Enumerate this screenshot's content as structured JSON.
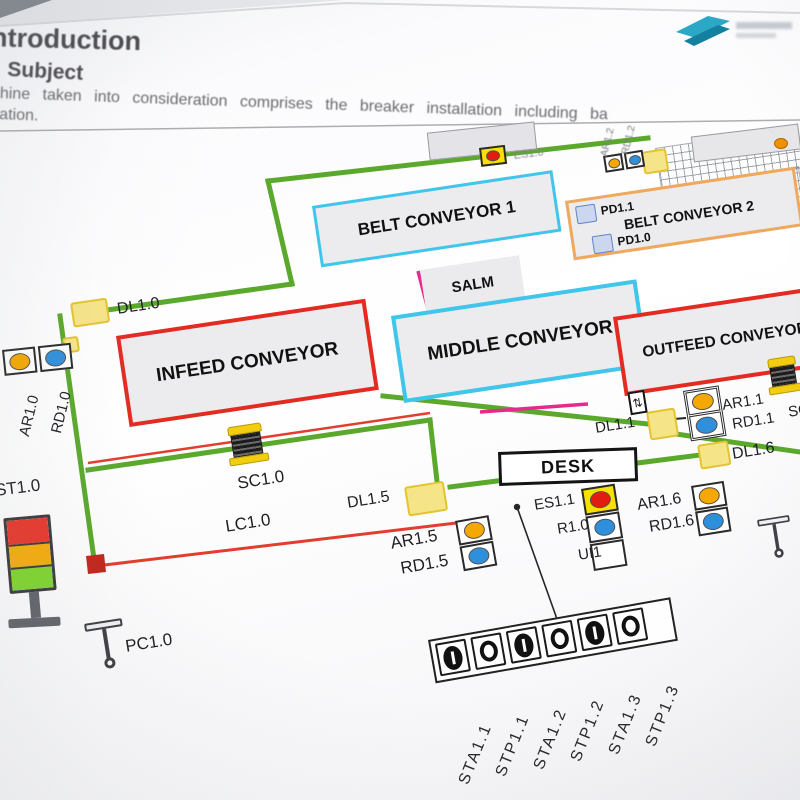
{
  "page": {
    "heading": "Introduction",
    "subheading": "Subject",
    "body_line1": "machine taken into consideration comprises the breaker installation including ba",
    "body_line2": "lation."
  },
  "diagram": {
    "boxes": {
      "belt_conveyor_1": "BELT CONVEYOR 1",
      "belt_conveyor_2": "BELT CONVEYOR 2",
      "salm": "SALM",
      "infeed": "INFEED CONVEYOR",
      "middle": "MIDDLE CONVEYOR",
      "outfeed": "OUTFEED CONVEYOR",
      "desk": "DESK"
    },
    "devices": {
      "dl10": "DL1.0",
      "dl11": "DL1.1",
      "dl15": "DL1.5",
      "dl16": "DL1.6",
      "ar10": "AR1.0",
      "rd10": "RD1.0",
      "ar11": "AR1.1",
      "rd11": "RD1.1",
      "ar12": "AR1.2",
      "rd12": "RD1.2",
      "ar15": "AR1.5",
      "rd15": "RD1.5",
      "ar16": "AR1.6",
      "rd16": "RD1.6",
      "es10": "ES1.0",
      "es11": "ES1.1",
      "r10": "R1.0",
      "ui1": "UI1",
      "st10": "ST1.0",
      "sc10": "SC1.0",
      "sc11": "SC1.1",
      "lc10": "LC1.0",
      "pc10": "PC1.0",
      "pd11": "PD1.1",
      "pd10": "PD1.0"
    },
    "buttons": [
      {
        "label": "STA1.1",
        "type": "start"
      },
      {
        "label": "STP1.1",
        "type": "stop"
      },
      {
        "label": "STA1.2",
        "type": "start"
      },
      {
        "label": "STP1.2",
        "type": "stop"
      },
      {
        "label": "STA1.3",
        "type": "start"
      },
      {
        "label": "STP1.3",
        "type": "stop"
      }
    ],
    "colors": {
      "fence_green": "#5aa82c",
      "safety_red": "#e23d2e",
      "conveyor_cyan": "#3fc6ea",
      "conveyor_red": "#e32b22",
      "belt2_orange": "#efa95e",
      "magenta": "#e8298c",
      "pad_yellow": "#f6e488",
      "indicator_orange": "#f4a800",
      "indicator_blue": "#2e90dc"
    }
  }
}
